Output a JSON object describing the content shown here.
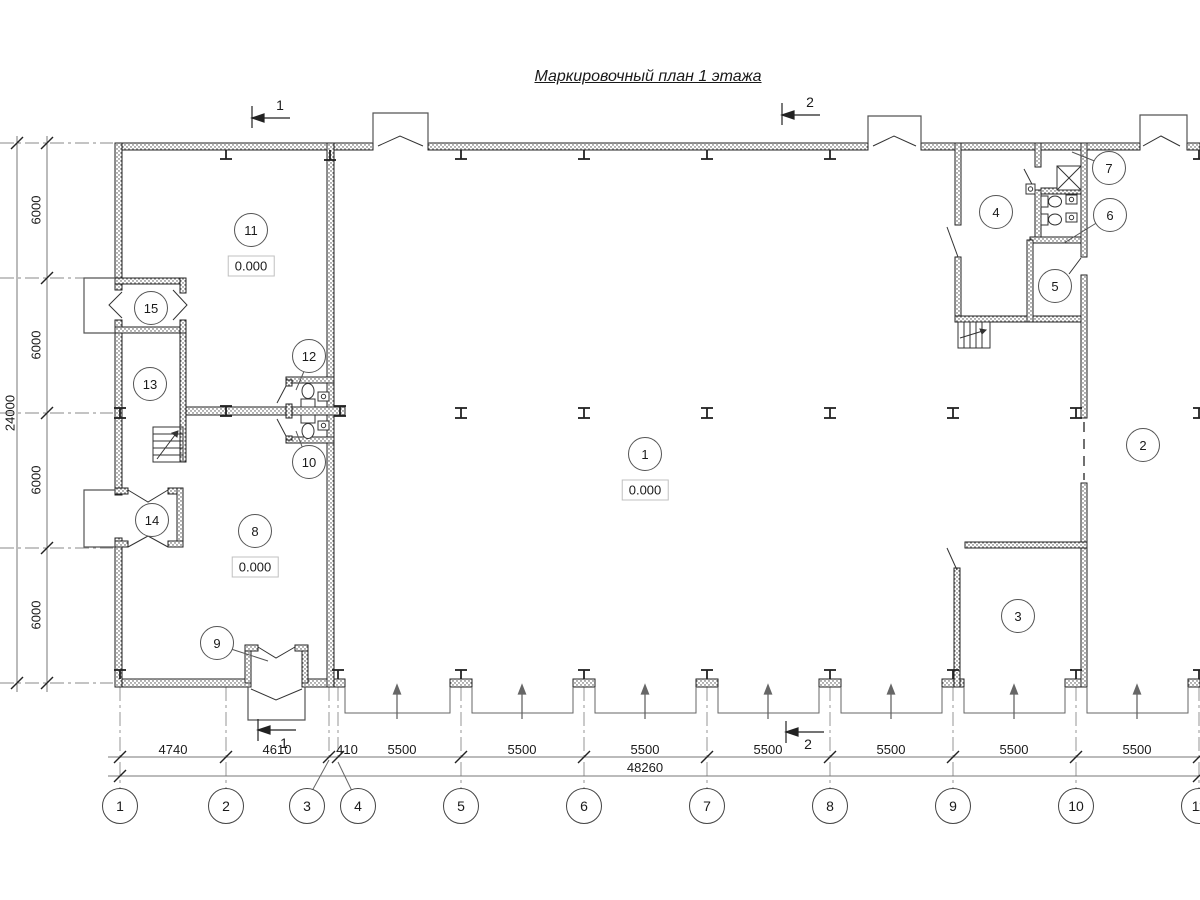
{
  "title": "Маркировочный план 1 этажа",
  "elevation": "0.000",
  "rooms": {
    "r1": "1",
    "r2": "2",
    "r3": "3",
    "r4": "4",
    "r5": "5",
    "r6": "6",
    "r7": "7",
    "r8": "8",
    "r9": "9",
    "r10": "10",
    "r11": "11",
    "r12": "12",
    "r13": "13",
    "r14": "14",
    "r15": "15"
  },
  "grid": {
    "cols": [
      "1",
      "2",
      "3",
      "4",
      "5",
      "6",
      "7",
      "8",
      "9",
      "10",
      "11"
    ]
  },
  "dims": {
    "h_segments": [
      "4740",
      "4610",
      "410",
      "5500",
      "5500",
      "5500",
      "5500",
      "5500",
      "5500",
      "5500"
    ],
    "h_total": "48260",
    "v_segments": [
      "6000",
      "6000",
      "6000",
      "6000"
    ],
    "v_total": "24000"
  },
  "sections": {
    "s1": "1",
    "s2": "2"
  },
  "colors": {
    "line": "#1a1a1a",
    "wall_stipple": "#444444",
    "dim_line": "#777777",
    "axis_line": "#8a8a8a"
  }
}
